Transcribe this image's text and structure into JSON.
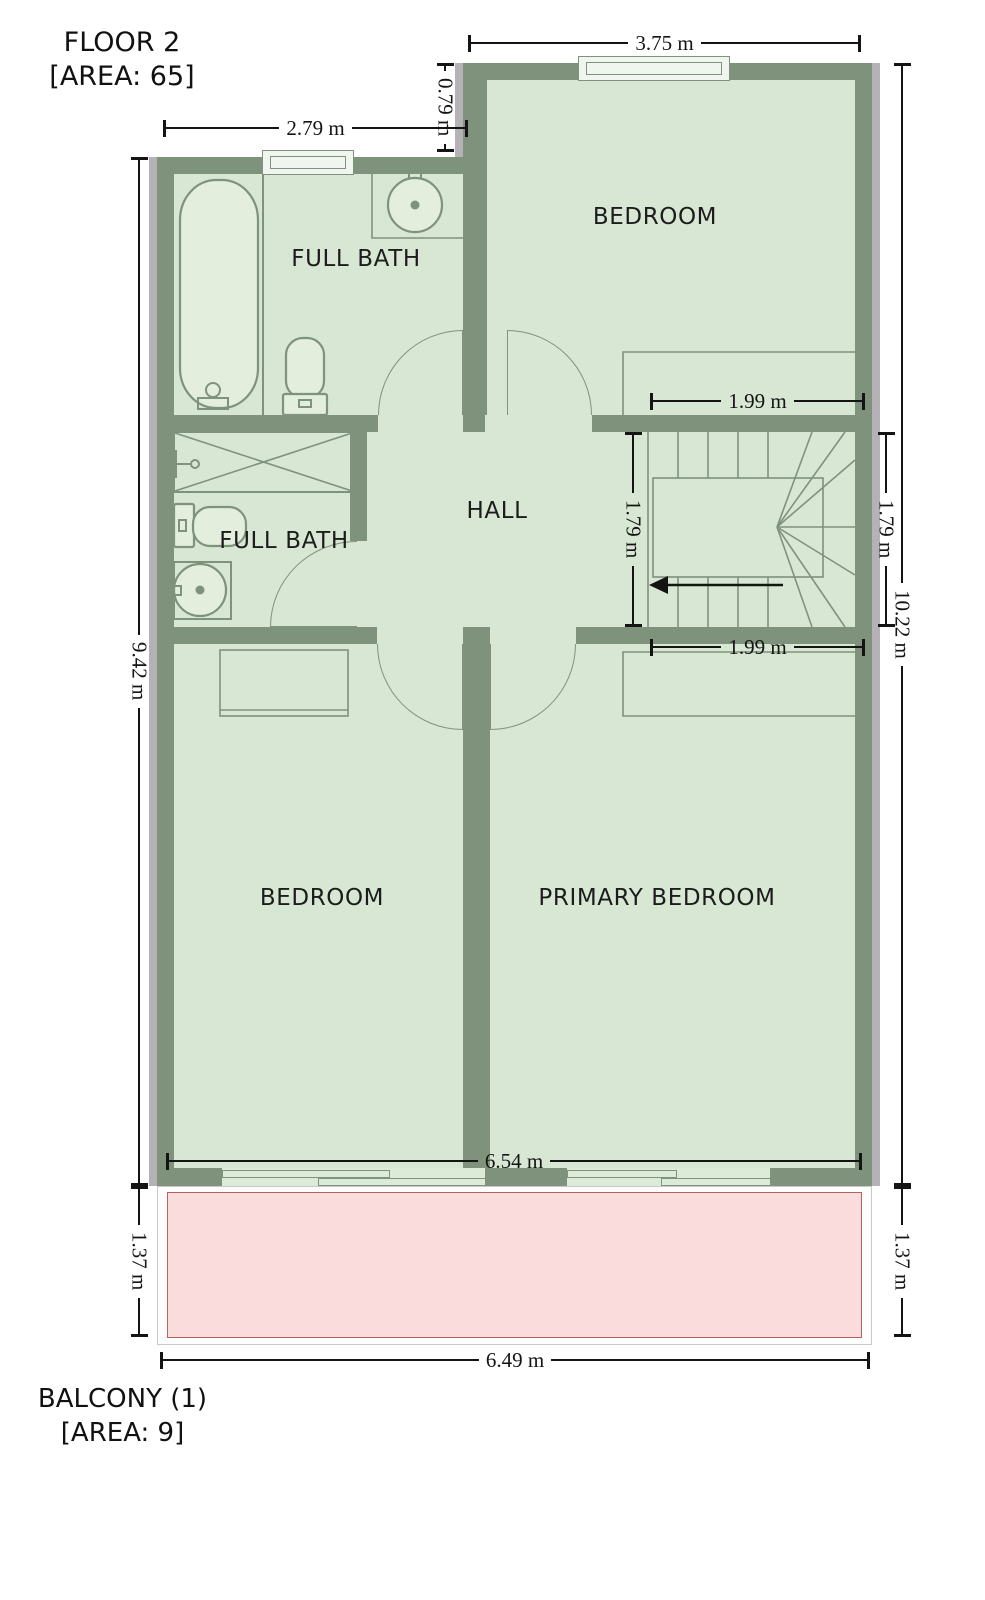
{
  "header": {
    "floor_title": "FLOOR 2",
    "floor_area": "[AREA: 65]"
  },
  "footer": {
    "balcony_title": "BALCONY (1)",
    "balcony_area": "[AREA: 9]"
  },
  "rooms": {
    "top_bath": "FULL BATH",
    "top_bedroom": "BEDROOM",
    "hall": "HALL",
    "lower_bath": "FULL BATH",
    "bedroom": "BEDROOM",
    "primary_bedroom": "PRIMARY BEDROOM"
  },
  "dimensions": {
    "bedroom_top_width": "3.75 m",
    "bath_top_width": "2.79 m",
    "wall_offset": "0.79 m",
    "stair_width_top": "1.99 m",
    "stair_width_bottom": "1.99 m",
    "stair_depth_inner": "1.79 m",
    "stair_depth_right": "1.79 m",
    "left_height": "9.42 m",
    "right_height": "10.22 m",
    "interior_width": "6.54 m",
    "balcony_height_left": "1.37 m",
    "balcony_height_right": "1.37 m",
    "balcony_width": "6.49 m"
  },
  "colors": {
    "wall": "#7f927b",
    "floor": "#d8e7d3",
    "fixture": "#e3eedd",
    "window": "#f1f5f0",
    "balcony_fill": "#fbdcdc",
    "balcony_border": "#b3625c",
    "shadow": "#b4b2b6",
    "dim": "#141414"
  }
}
